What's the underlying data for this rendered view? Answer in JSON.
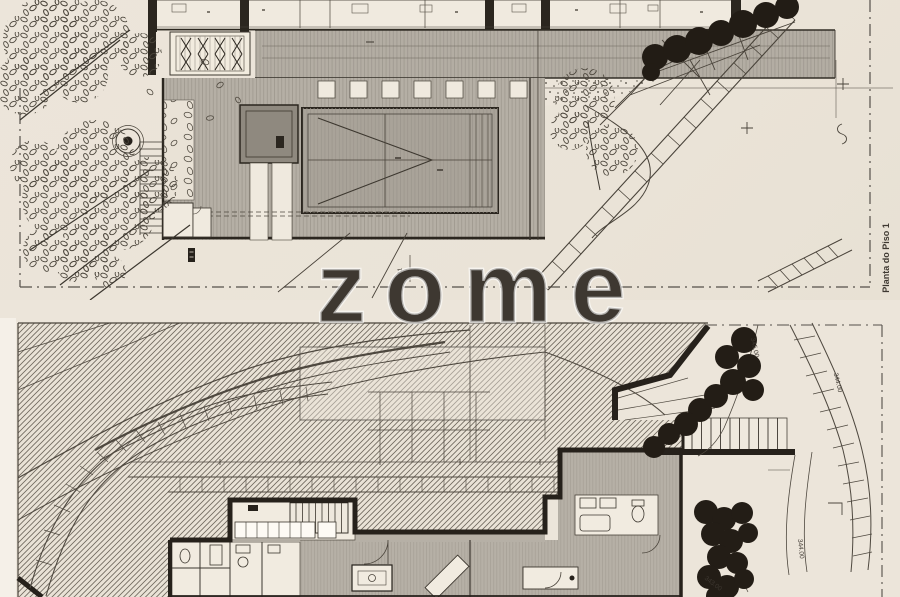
{
  "sheet": {
    "paper_color": "#ebe4d8",
    "ink_color": "#49433a",
    "wall_color": "#26211b",
    "deck_color": "#b5afa5",
    "tree_color": "#231d16",
    "watermark_text": "zome",
    "upper_plan": {
      "title": "Planta do Piso 1",
      "section_marker": "C1"
    },
    "lower_plan": {
      "elevations": [
        {
          "text": "345.00"
        },
        {
          "text": "344.00"
        },
        {
          "text": "343.00"
        },
        {
          "text": "344.00"
        }
      ]
    }
  }
}
